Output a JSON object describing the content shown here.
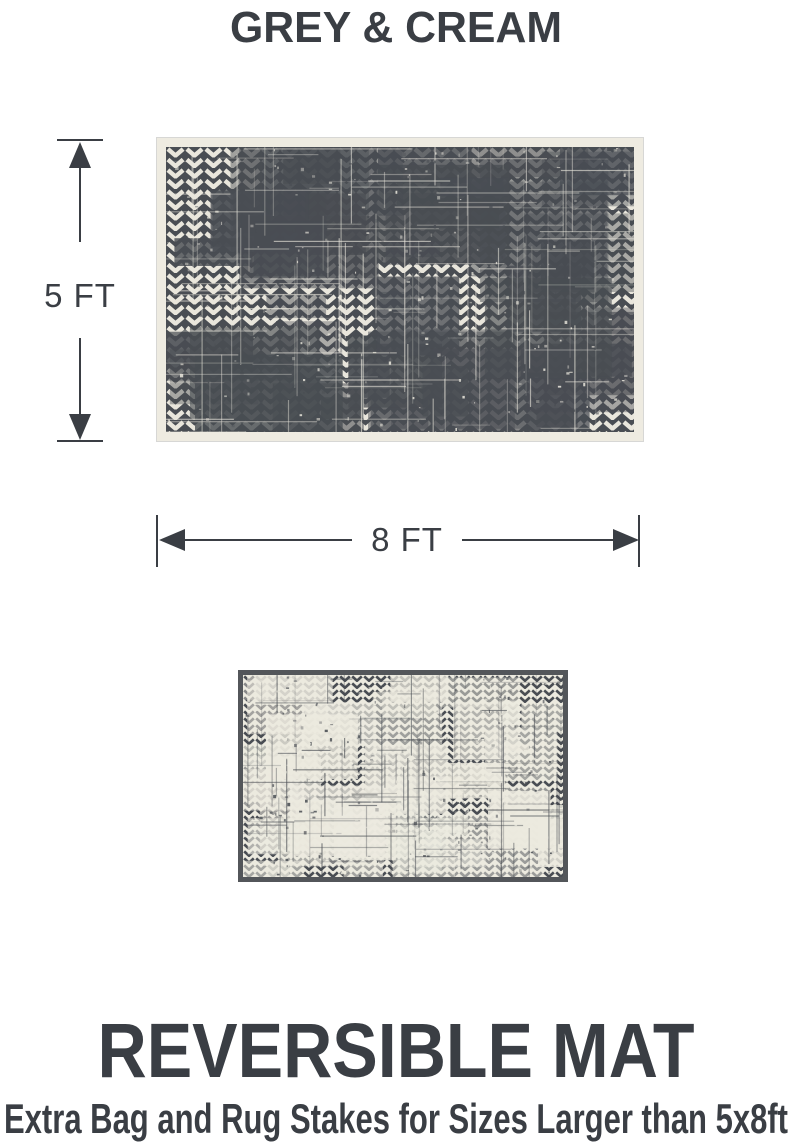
{
  "title": "GREY & CREAM",
  "dimension_labels": {
    "height": "5 FT",
    "width": "8 FT"
  },
  "footer": {
    "heading": "REVERSIBLE MAT",
    "subheading": "Extra Bag and Rug Stakes for Sizes Larger than 5x8ft"
  },
  "colors": {
    "text": "#3a3e44",
    "mat_dark_grey": "#494d53",
    "mat_cream": "#eeebe1",
    "small_mat_frame": "#53565a"
  },
  "mats": {
    "large": {
      "base": "#494d53",
      "accent": "#e9e6dc"
    },
    "small": {
      "base": "#eceadf",
      "accent": "#494d53"
    }
  }
}
